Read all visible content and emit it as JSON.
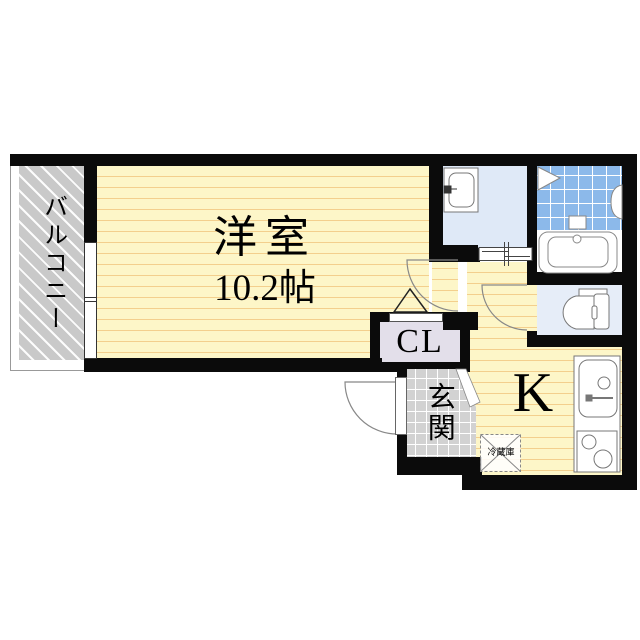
{
  "title": "apartment-floor-plan",
  "rooms": {
    "balcony": {
      "label": "バルコニー"
    },
    "western_room": {
      "label": "洋室",
      "size": "10.2帖"
    },
    "closet": {
      "label": "CL"
    },
    "entrance": {
      "label": "玄関"
    },
    "kitchen": {
      "label": "K"
    },
    "refrigerator": {
      "label": "冷蔵庫"
    }
  },
  "fixtures": [
    "washing-machine",
    "bathtub",
    "bath-folding-door",
    "toilet",
    "kitchen-sink",
    "stove",
    "refrigerator-space",
    "sliding-door",
    "balcony-window",
    "entrance-door"
  ],
  "colors": {
    "wall": "#0b0b0b",
    "room_floor": "#fdf6c8",
    "room_stripe": "#f3cf8d",
    "balcony_floor": "#c9c9c9",
    "washroom_floor": "#dfe9f7",
    "toilet_floor": "#e6edf8",
    "bath_tile": "#8cb9ea",
    "closet_floor": "#e3dfea",
    "entrance_floor": "#d2d2d2"
  }
}
